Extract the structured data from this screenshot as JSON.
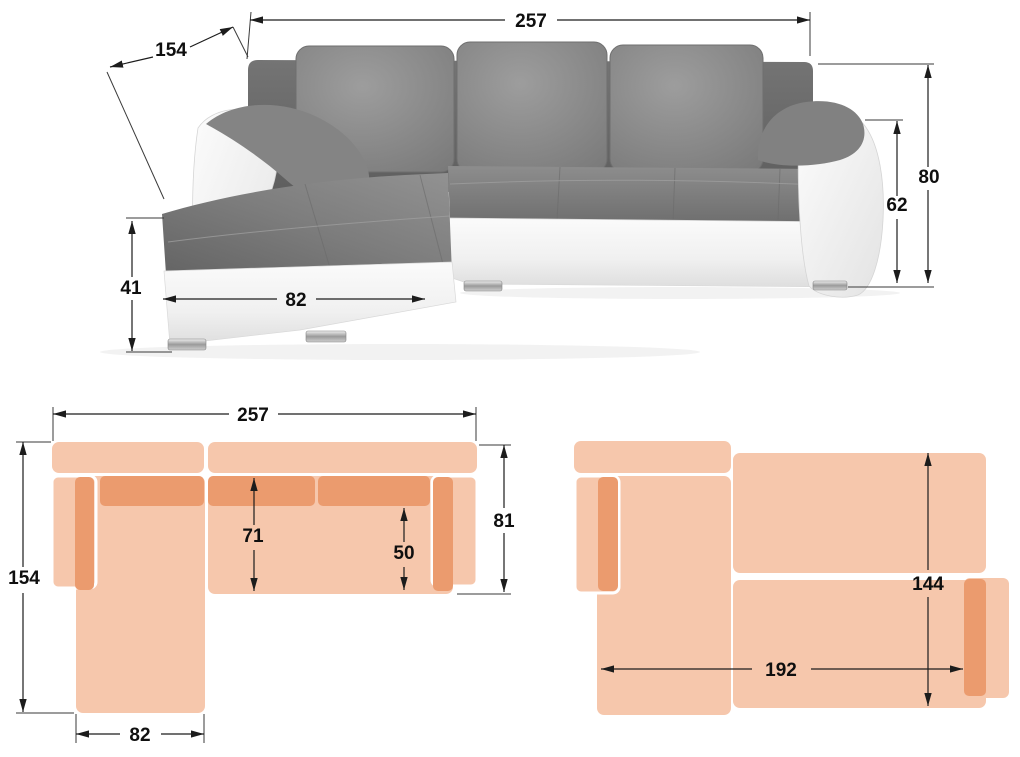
{
  "front_view": {
    "overall_width": "257",
    "chaise_depth": "154",
    "base_height": "41",
    "chaise_front_width": "82",
    "total_height": "80",
    "armrest_height": "62"
  },
  "top_view": {
    "overall_width": "257",
    "overall_depth": "154",
    "chaise_width": "82",
    "seat_depth": "71",
    "right_seat_depth": "50",
    "sofa_depth": "81"
  },
  "bed_view": {
    "bed_length": "192",
    "bed_width": "144"
  },
  "colors": {
    "plan_light": "#f6c7ac",
    "plan_dark": "#eb9b6e",
    "dimension_line": "#1c1c1c",
    "sofa_fabric_gray": "#828282",
    "sofa_leather_white": "#f2f2f2"
  }
}
